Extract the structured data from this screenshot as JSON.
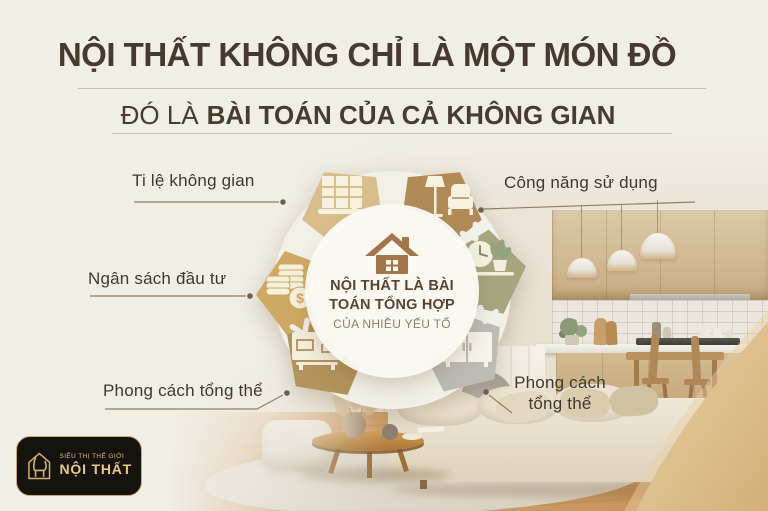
{
  "header": {
    "title": "NỘI THẤT KHÔNG CHỈ LÀ MỘT MÓN ĐỒ",
    "subtitle_regular": "ĐÓ LÀ",
    "subtitle_bold": "BÀI TOÁN CỦA CẢ KHÔNG GIAN"
  },
  "wheel": {
    "center": {
      "line1": "NỘI THẤT LÀ BÀI",
      "line2": "TOÁN TỔNG HỢP",
      "line3": "CỦA NHIỀU YẾU TỐ"
    },
    "segments": [
      {
        "position": "top-left",
        "label": "Ti lệ không gian",
        "icon": "window-icon",
        "color": "#d9bd8b"
      },
      {
        "position": "top-right",
        "label": "Công năng sử dụng",
        "icon": "lamp-armchair-icon",
        "color": "#b28a58"
      },
      {
        "position": "left",
        "label": "Ngân sách đầu tư",
        "icon": "coins-icon",
        "color": "#cfa963",
        "symbol": "$"
      },
      {
        "position": "right",
        "label": "",
        "icon": "clock-plant-icon",
        "color": "#a6a580"
      },
      {
        "position": "bottom-left",
        "label": "Phong cách tổng thể",
        "icon": "tv-console-icon",
        "color": "#b2935b"
      },
      {
        "position": "bottom-right",
        "label": "Phong cách tổng thể",
        "icon": "cabinet-icon",
        "color": "#bdbbb4"
      }
    ]
  },
  "logo": {
    "tagline": "SIÊU THỊ THẾ GIỚI",
    "name": "NỘI THẤT",
    "icon": "chair-house-icon"
  },
  "colors": {
    "paper": "#f1eee6",
    "title_text": "#46392d",
    "label_text": "#3e3931",
    "center_text": "#5a4330",
    "center_text_light": "#8d7d66",
    "house_brown": "#a3764a",
    "logo_gold": "#d9ba77",
    "logo_bg": "#16130f"
  }
}
